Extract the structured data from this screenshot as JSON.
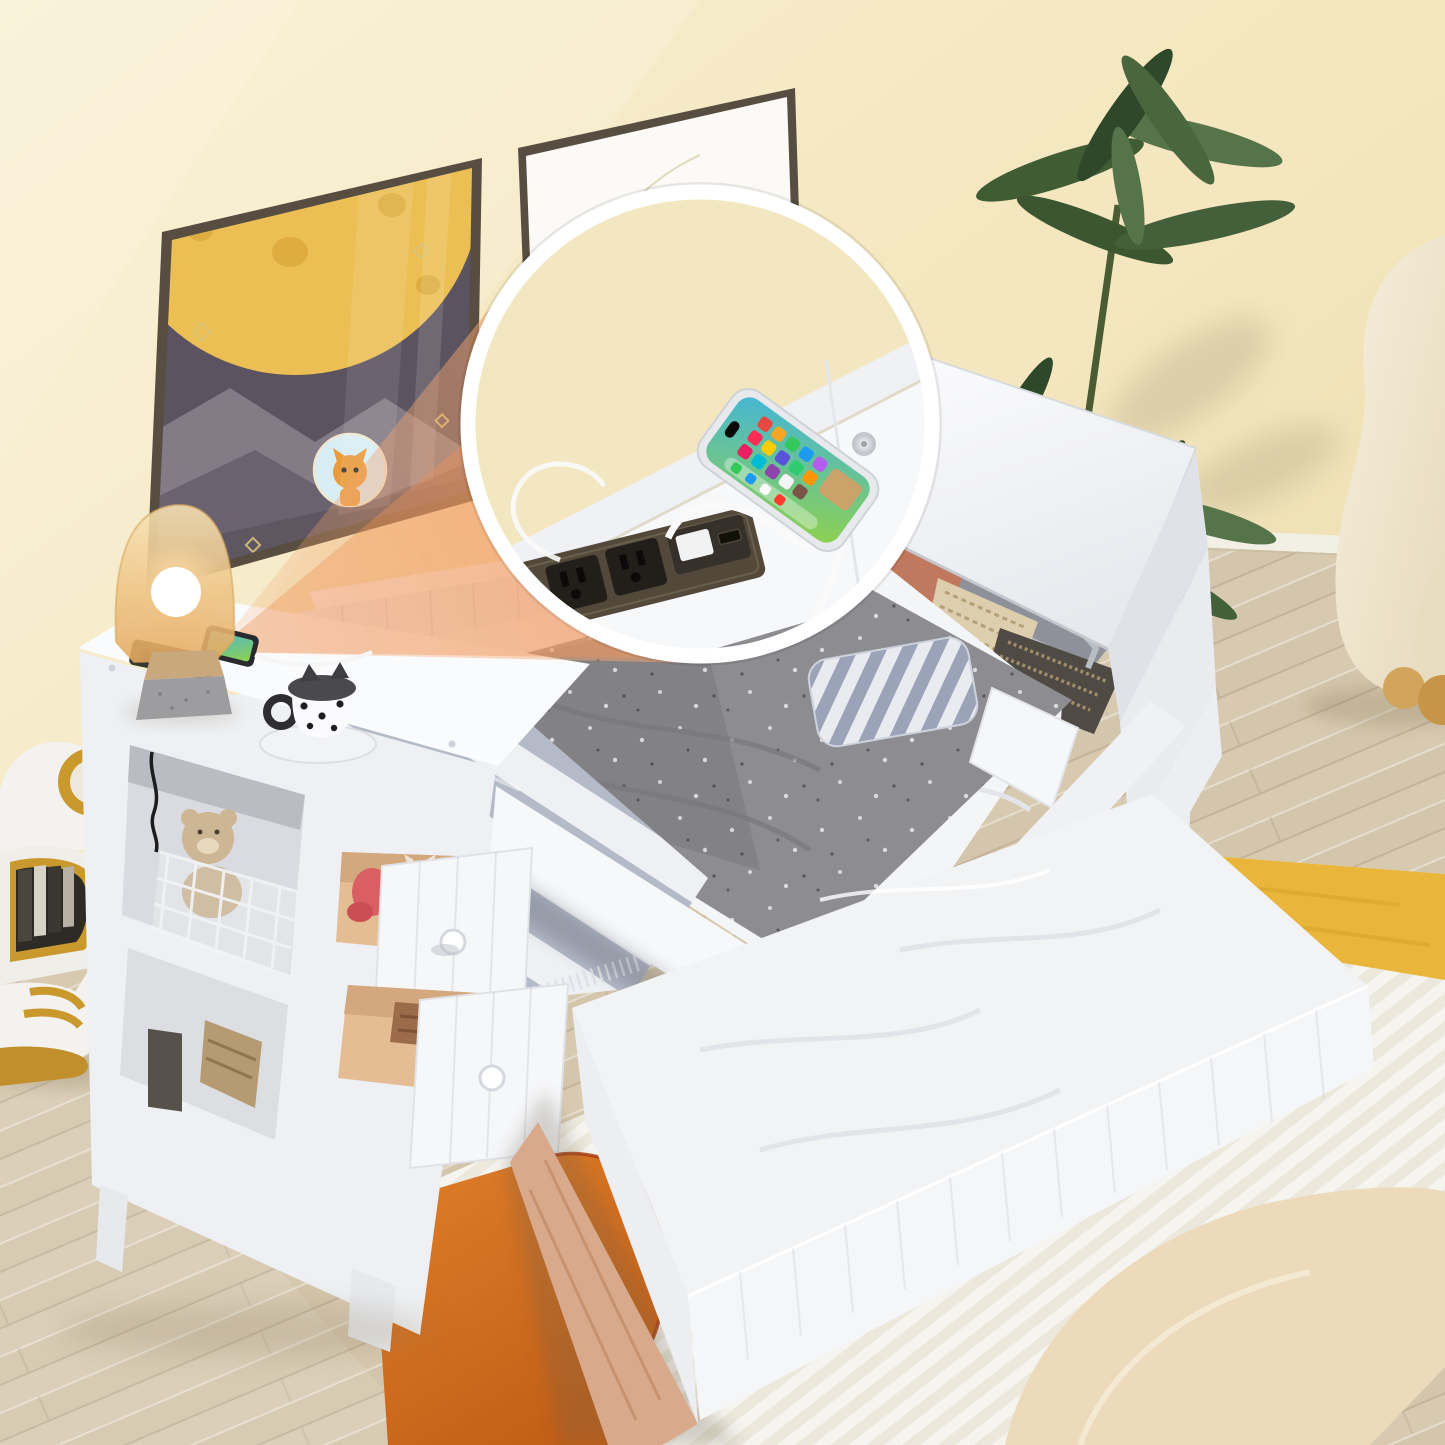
{
  "scene": {
    "type": "product-photo",
    "alt": "Kids twin daybed with trundle, storage drawers, shelves and built-in charging station in a cream bedroom",
    "labels": {
      "inset": "charging-station-magnifier",
      "bed": "white-twin-daybed",
      "trundle": "pull-out-trundle-bed",
      "drawers": "two-open-storage-drawers",
      "shelf": "side-storage-shelf",
      "lid_box": "flip-top-storage-compartment",
      "lamp": "amber-table-lamp",
      "mug": "polka-dot-cat-mug",
      "phone": "smartphone-charging",
      "outlets": "dual-ac-outlets",
      "usb": "usb-charging-ports",
      "art_left": "moon-cat-wall-art",
      "art_right": "little-cat-wall-art",
      "plant": "green-house-plant",
      "chair": "cream-armchair",
      "robot": "robot-bear-book-shelf",
      "rug": "striped-area-rug"
    }
  },
  "colors": {
    "wall": "#f3e5bc",
    "wallLight": "#f9f0d0",
    "wallDark": "#e9d9a9",
    "floor": "#d8cab1",
    "floorAlt": "#d2c3a8",
    "baseboard": "#f2efe4",
    "white": "#f4f5f7",
    "whiteBright": "#fafbfc",
    "whiteShade": "#e6e8ed",
    "whiteDark": "#d4d7de",
    "frame": "#574e41",
    "artSky": "#5b5360",
    "artMoon": "#ecbf55",
    "artCrater": "#dca93c",
    "artMountain": "#837b85",
    "artMountainDark": "#6b6270",
    "catOrange": "#e89a3c",
    "art2bg": "#fbfaf6",
    "blanket": "#8d8d91",
    "blanketDark": "#737377",
    "stripeGray": "#b4bac8",
    "stripeWhite": "#eef0f4",
    "pillowStripe": "#9aa3b8",
    "terracotta": "#c0795f",
    "beigePillow": "#ddcfae",
    "darkPillow": "#4f4a43",
    "drawerWood": "#e5bd95",
    "drawerWoodDark": "#c49a70",
    "trundleWood": "#d9a98c",
    "beam": "#f4a46e",
    "rugWhite": "#f6f4ef",
    "rugRib": "#ebe7db",
    "rugOrange": "#d3691c",
    "rugOrangeDeep": "#a83d12",
    "rugYellow": "#e9b63b",
    "rugBeige": "#ecdaba",
    "plantGreen": "#3f5c33",
    "plantLight": "#567449",
    "chairCream": "#f3ecd9",
    "chairWood": "#d2a45c",
    "lampGlassTop": "#f8e3b4",
    "lampGlassBottom": "#e5a95e",
    "lampBaseTan": "#c8a87c",
    "lampBaseGray": "#9d9da0",
    "stripPlate": "#53493a",
    "outletBlack": "#221f1a",
    "usbPlug": "#f2f2f2",
    "cable": "#fafafa",
    "phoneFrame": "#e8e9ec",
    "screenTeal": "#45b6d6",
    "screenGreen": "#8fd14e",
    "gold": "#c9992e",
    "teddy": "#cdb694",
    "mugLid": "#4a4a4e"
  }
}
